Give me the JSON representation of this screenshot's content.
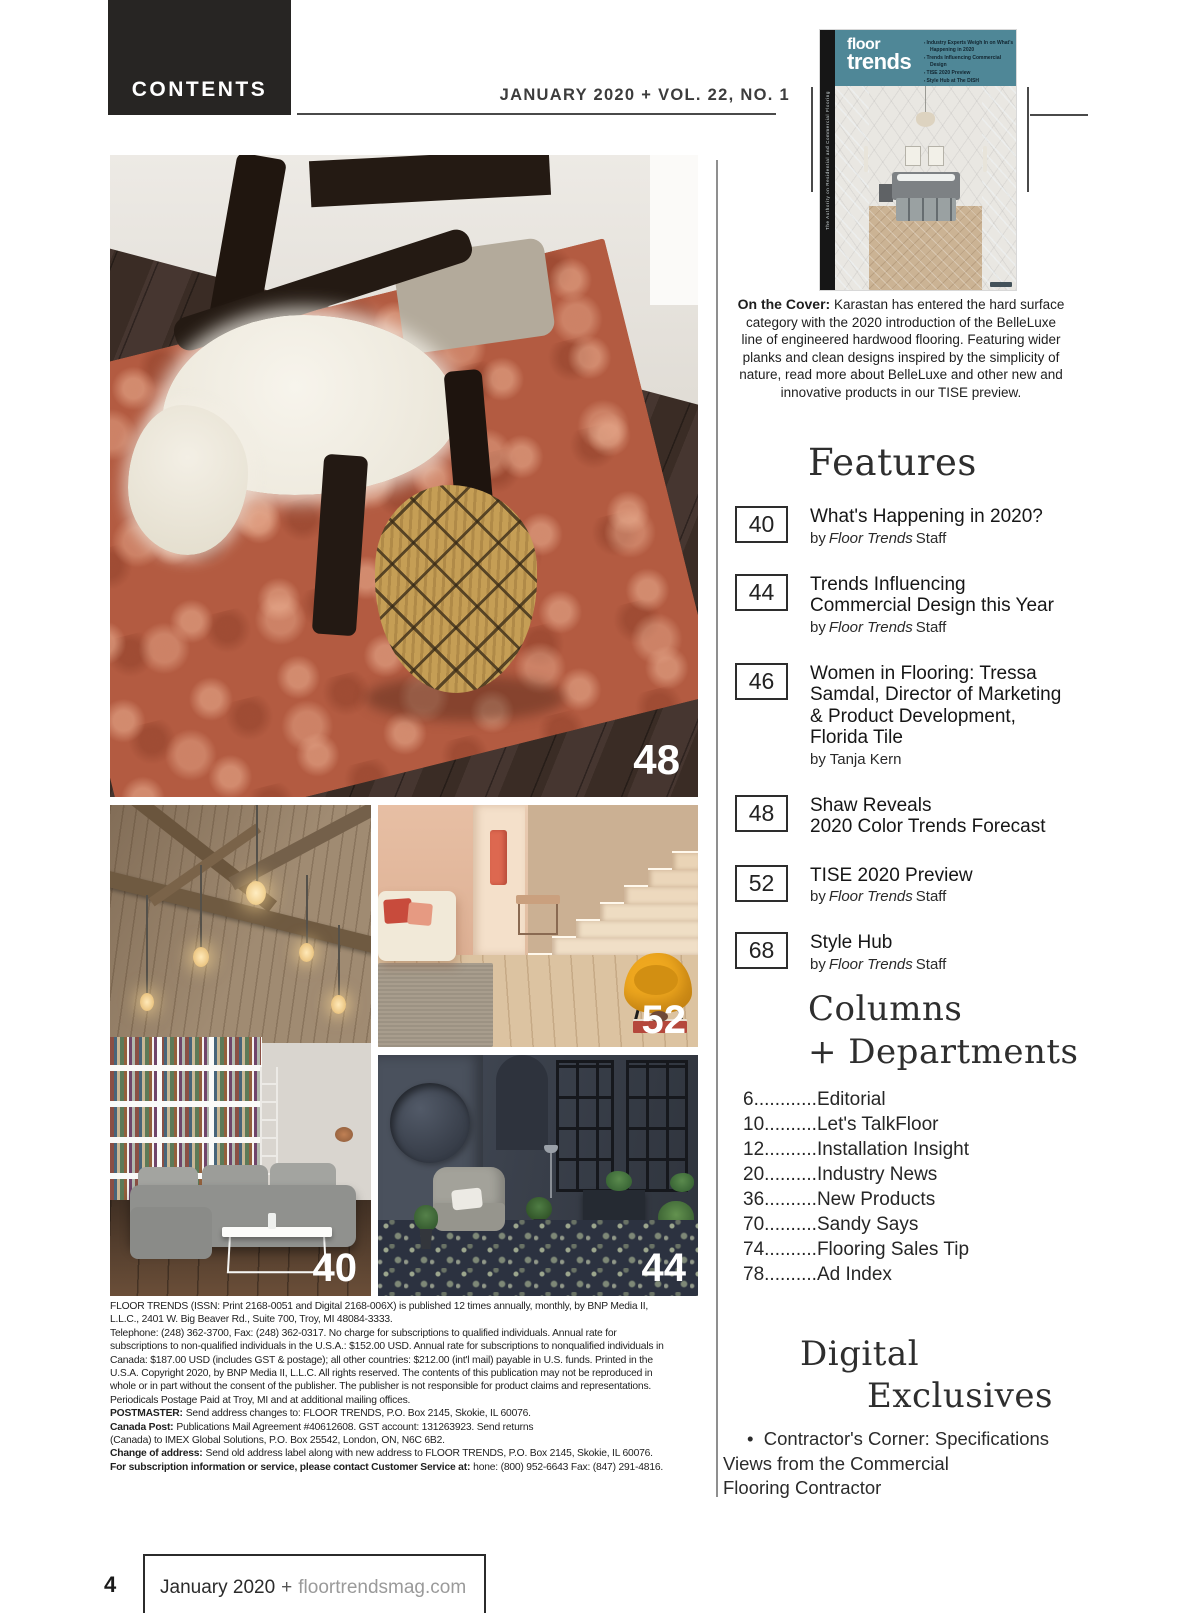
{
  "colors": {
    "brand_teal": "#4f8797",
    "header_bar": "#272523",
    "terracotta_rug": "#b35b41",
    "mustard_chair": "#efa81f"
  },
  "header": {
    "contents_label": "CONTENTS",
    "issue_line": "JANUARY 2020 + VOL. 22, NO. 1"
  },
  "cover": {
    "magazine_name_line1": "floor",
    "magazine_name_line2": "trends",
    "spine_text": "The Authority on Residential and Commercial Flooring",
    "coverlines": [
      "Industry Experts Weigh In on What's Happening in 2020",
      "Trends Influencing Commercial Design",
      "TISE 2020 Preview",
      "Style Hub at The DISH"
    ]
  },
  "on_the_cover": {
    "label": "On the Cover:",
    "text": "Karastan has entered the hard surface category with the 2020 introduction of the BelleLuxe line of engineered hardwood flooring. Featuring wider planks and clean designs inspired by the simplicity of nature, read more about BelleLuxe and other new and innovative products in our TISE preview."
  },
  "features": {
    "heading": "Features",
    "items": [
      {
        "page": "40",
        "title": "What's Happening in 2020?",
        "by_pre": "by",
        "by_italic": "Floor Trends",
        "by_post": "Staff"
      },
      {
        "page": "44",
        "title": "Trends Influencing Commercial Design this Year",
        "by_pre": "by",
        "by_italic": "Floor Trends",
        "by_post": "Staff"
      },
      {
        "page": "46",
        "title": "Women in Flooring: Tressa Samdal, Director of Marketing & Product Development, Florida Tile",
        "by_pre": "by Tanja Kern",
        "by_italic": "",
        "by_post": ""
      },
      {
        "page": "48",
        "title": "Shaw Reveals\n2020 Color Trends Forecast"
      },
      {
        "page": "52",
        "title": "TISE 2020 Preview",
        "by_pre": "by",
        "by_italic": "Floor Trends",
        "by_post": "Staff"
      },
      {
        "page": "68",
        "title": "Style Hub",
        "by_pre": "by",
        "by_italic": "Floor Trends",
        "by_post": "Staff"
      }
    ]
  },
  "departments": {
    "heading_line1": "Columns",
    "heading_line2": "+ Departments",
    "items": [
      {
        "page": "6",
        "dots": "............",
        "label": "Editorial"
      },
      {
        "page": "10",
        "dots": "..........",
        "label": "Let's TalkFloor"
      },
      {
        "page": "12",
        "dots": "..........",
        "label": "Installation Insight"
      },
      {
        "page": "20",
        "dots": "..........",
        "label": "Industry News"
      },
      {
        "page": "36",
        "dots": "..........",
        "label": "New Products"
      },
      {
        "page": "70",
        "dots": "..........",
        "label": "Sandy Says"
      },
      {
        "page": "74",
        "dots": "..........",
        "label": "Flooring Sales Tip"
      },
      {
        "page": "78",
        "dots": "..........",
        "label": "Ad Index"
      }
    ]
  },
  "digital": {
    "heading_line1": "Digital",
    "heading_line2": "Exclusives",
    "bullet": "•",
    "line1": "Contractor's Corner: Specifications",
    "line2": "Views from the Commercial",
    "line3": "Flooring Contractor"
  },
  "photos": {
    "main_rug": {
      "page": "48"
    },
    "library": {
      "page": "40"
    },
    "stairs": {
      "page": "52"
    },
    "dark_room": {
      "page": "44"
    }
  },
  "fine_print": {
    "p1": "FLOOR TRENDS (ISSN: Print 2168-0051 and Digital 2168-006X) is published 12 times annually, monthly, by BNP Media II, L.L.C., 2401 W. Big Beaver Rd., Suite 700, Troy, MI  48084-3333.",
    "p2": "Telephone: (248) 362-3700, Fax: (248) 362-0317. No charge for subscriptions to qualified individuals. Annual rate for subscriptions to non-qualified individuals in the U.S.A.:  $152.00 USD. Annual rate for subscriptions to nonqualified individuals in Canada: $187.00 USD (includes GST & postage); all other countries: $212.00 (int'l mail) payable in U.S. funds. Printed in the U.S.A. Copyright 2020, by BNP Media II, L.L.C. All rights reserved. The contents of this publication may not be reproduced in whole or in part without the consent of the publisher. The publisher is not responsible for product claims and representations. Periodicals Postage Paid at Troy, MI and at additional mailing offices.",
    "postmaster_label": "POSTMASTER:",
    "postmaster_text": "Send address changes to: FLOOR TRENDS, P.O. Box 2145, Skokie, IL  60076.",
    "canada_label": "Canada Post:",
    "canada_text": "Publications Mail Agreement #40612608. GST account: 131263923. Send returns",
    "canada_text2": "(Canada) to IMEX Global Solutions, P.O. Box 25542, London, ON, N6C 6B2.",
    "change_label": "Change of address:",
    "change_text": "Send old address label along with new address to FLOOR TRENDS, P.O. Box 2145, Skokie, IL  60076.",
    "subscription_label": "For subscription information or service, please contact Customer Service at:",
    "subscription_text": "hone: (800) 952-6643 Fax: (847) 291-4816."
  },
  "footer": {
    "page_number": "4",
    "issue": "January 2020",
    "plus": "+",
    "site": "floortrendsmag.com"
  }
}
